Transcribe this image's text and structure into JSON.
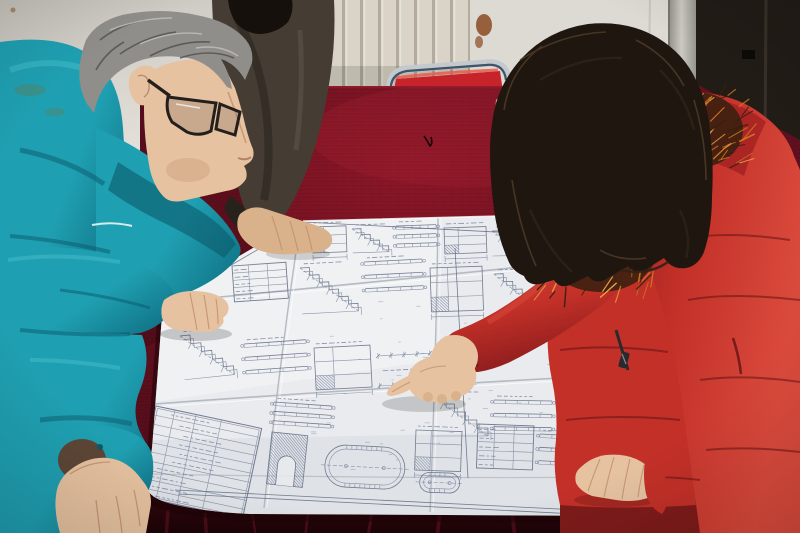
{
  "meta": {
    "domain": "photograph",
    "description": "Three workers gathered around a table covered with dark red velvet, reviewing a large folded engineering blueprint. A gray-haired man in a teal work jacket and glasses leans over the drawing at left; a colleague in a dark jacket rests a hand on the sheet behind him; a woman with long dark hair, wearing a red down coat with an orange fur-trimmed hood, points at a detail on the drawing.",
    "setting": "indoor room with white radiator wall, light wall panel and dark door at right",
    "people_count": 3
  },
  "palette": {
    "wall_light": "#e4e2db",
    "wall_shadow": "#c7c4bc",
    "radiator": "#d9d4c7",
    "radiator_fin": "#a69f90",
    "wall_right": "#dcdad3",
    "rust": "#8a4a21",
    "frame_light": "#cbcac3",
    "frame_mid": "#8f8d85",
    "door_dark": "#221c17",
    "door_edge": "#3b342c",
    "chair_chrome": "#c3c9cc",
    "chair_chrome_dark": "#5a6a78",
    "chair_navy": "#31475e",
    "chair_red": "#c6242a",
    "chair_red_hi": "#ea5a4e",
    "velvet_bright": "#8e1727",
    "velvet_mid": "#64101f",
    "velvet_dark": "#430a16",
    "velvet_edge": "#2c060d",
    "velvet_sheen": "#a32033",
    "paper": "#e9ebee",
    "paper_light": "#f4f5f7",
    "paper_shade": "#d2d6db",
    "paper_warm": "#e5e0d6",
    "crease": "#b4bac2",
    "ink": "#76819b",
    "ink_dark": "#5d6880",
    "teal": "#1fa0b2",
    "teal_dark": "#117487",
    "teal_deep": "#0b5a6b",
    "teal_light": "#45bdcb",
    "piping": "#e8f4f4",
    "stain_olive": "#6b7a4a",
    "skin": "#e6c2a0",
    "skin_dark": "#d9b28c",
    "skin_shadow": "#c0906c",
    "skin_deep": "#a5765a",
    "hair_gray": "#8f8e8a",
    "hair_gray_dark": "#504f4b",
    "hair_gray_light": "#bdbcb8",
    "glasses": "#241f1c",
    "djacket": "#453c33",
    "djacket_dark": "#28221c",
    "dhair": "#15100b",
    "whair": "#1f1610",
    "whair_mid": "#2e2217",
    "whair_light": "#55402a",
    "coat": "#c23028",
    "coat_light": "#da4a3c",
    "coat_dark": "#8e1d1d",
    "coat_deep": "#611314",
    "hood": "#a82425",
    "fur_base": "#35200e",
    "fur_orange": "#cf7a22",
    "fur_light": "#eda847",
    "lining": "#5d4636",
    "zipper": "#2a2a2e",
    "shadow": "#1c0306"
  },
  "velvet": {
    "front_streaks": [
      168,
      205,
      252,
      308,
      372,
      441,
      512,
      586,
      668,
      742,
      778
    ],
    "texture_opacity": 0.5
  },
  "fur": {
    "upper": {
      "x": 648,
      "y": 92,
      "w": 95,
      "h": 76,
      "count": 60,
      "angle": -35,
      "spread": 50
    },
    "lower": {
      "x": 542,
      "y": 202,
      "w": 116,
      "h": 90,
      "count": 70,
      "angle": 115,
      "spread": 55
    }
  },
  "blueprint": {
    "clusters": [
      {
        "t": "elev",
        "x": 312,
        "y": 227,
        "w": 34,
        "h": 26,
        "r": -2
      },
      {
        "t": "stair",
        "x": 352,
        "y": 229,
        "w": 36,
        "h": 24,
        "r": -2,
        "n": 4
      },
      {
        "t": "beams",
        "x": 396,
        "y": 226,
        "w": 40,
        "h": 27,
        "r": -2
      },
      {
        "t": "elev",
        "x": 444,
        "y": 228,
        "w": 42,
        "h": 26,
        "r": -2
      },
      {
        "t": "stair",
        "x": 492,
        "y": 231,
        "w": 36,
        "h": 25,
        "r": -1,
        "n": 4
      },
      {
        "t": "elev",
        "x": 534,
        "y": 233,
        "w": 40,
        "h": 26,
        "r": -1
      },
      {
        "t": "beams",
        "x": 580,
        "y": 236,
        "w": 38,
        "h": 25,
        "r": -1
      },
      {
        "t": "elev",
        "x": 624,
        "y": 239,
        "w": 32,
        "h": 23,
        "r": 0
      },
      {
        "t": "table",
        "x": 232,
        "y": 266,
        "w": 54,
        "h": 36,
        "r": -4,
        "n": 5
      },
      {
        "t": "stair",
        "x": 300,
        "y": 268,
        "w": 56,
        "h": 46,
        "r": -3,
        "n": 6
      },
      {
        "t": "beams",
        "x": 364,
        "y": 262,
        "w": 58,
        "h": 40,
        "r": -3
      },
      {
        "t": "elev",
        "x": 430,
        "y": 268,
        "w": 52,
        "h": 44,
        "r": -2
      },
      {
        "t": "stair",
        "x": 494,
        "y": 274,
        "w": 46,
        "h": 40,
        "r": -2,
        "n": 5
      },
      {
        "t": "beams",
        "x": 548,
        "y": 280,
        "w": 44,
        "h": 38,
        "r": -2
      },
      {
        "t": "stair",
        "x": 180,
        "y": 336,
        "w": 50,
        "h": 44,
        "r": -6,
        "n": 5
      },
      {
        "t": "beams",
        "x": 244,
        "y": 344,
        "w": 62,
        "h": 40,
        "r": -4
      },
      {
        "t": "elev",
        "x": 314,
        "y": 348,
        "w": 56,
        "h": 42,
        "r": -3
      },
      {
        "t": "dims",
        "x": 378,
        "y": 356,
        "w": 52,
        "h": 30,
        "r": -3
      },
      {
        "t": "stair",
        "x": 432,
        "y": 396,
        "w": 56,
        "h": 40,
        "r": 0,
        "n": 5
      },
      {
        "t": "beams",
        "x": 494,
        "y": 400,
        "w": 58,
        "h": 40,
        "r": 1
      },
      {
        "t": "table",
        "x": 560,
        "y": 396,
        "w": 40,
        "h": 34,
        "r": 2,
        "n": 4
      },
      {
        "t": "titleblock",
        "x": 156,
        "y": 406,
        "w": 108,
        "h": 92,
        "r": 12,
        "n": 10
      },
      {
        "t": "beams",
        "x": 274,
        "y": 402,
        "w": 58,
        "h": 28,
        "r": 4
      },
      {
        "t": "hatchrect",
        "x": 272,
        "y": 432,
        "w": 36,
        "h": 52,
        "r": 6,
        "notch": true
      },
      {
        "t": "racetrack",
        "x": 326,
        "y": 444,
        "w": 80,
        "h": 42,
        "r": 3
      },
      {
        "t": "elev",
        "x": 416,
        "y": 430,
        "w": 46,
        "h": 40,
        "r": 2
      },
      {
        "t": "table",
        "x": 478,
        "y": 424,
        "w": 56,
        "h": 44,
        "r": 2,
        "n": 5
      },
      {
        "t": "beams",
        "x": 540,
        "y": 434,
        "w": 60,
        "h": 40,
        "r": 3
      },
      {
        "t": "racetrack",
        "x": 420,
        "y": 472,
        "w": 40,
        "h": 20,
        "r": 2
      },
      {
        "t": "scatter",
        "x": 310,
        "y": 300,
        "w": 330,
        "h": 180,
        "n": 60
      },
      {
        "t": "longline",
        "pts": [
          [
            303,
            222
          ],
          [
            650,
            240
          ]
        ]
      },
      {
        "t": "longline",
        "pts": [
          [
            175,
            490
          ],
          [
            640,
            513
          ]
        ]
      },
      {
        "t": "longline",
        "pts": [
          [
            178,
            494
          ],
          [
            636,
            517
          ]
        ]
      },
      {
        "t": "longline",
        "pts": [
          [
            455,
            248
          ],
          [
            468,
            478
          ]
        ]
      },
      {
        "t": "longline",
        "pts": [
          [
            300,
            225
          ],
          [
            166,
            303
          ]
        ]
      }
    ]
  }
}
